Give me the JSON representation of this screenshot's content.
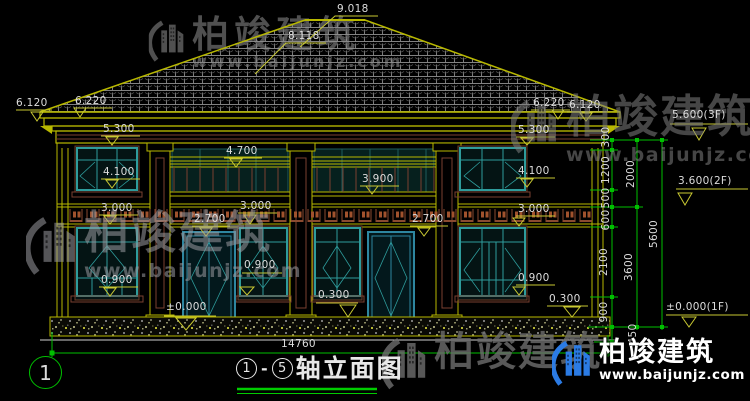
{
  "drawing": {
    "title": {
      "axis_from": "1",
      "dash": "-",
      "axis_to": "5",
      "text": "轴立面图"
    },
    "axis_marker": "1",
    "dim_labels": [
      {
        "t": "9.018",
        "x": 337,
        "y": 4
      },
      {
        "t": "8.118",
        "x": 288,
        "y": 31
      },
      {
        "t": "6.120",
        "x": 16,
        "y": 98
      },
      {
        "t": "6.220",
        "x": 75,
        "y": 96
      },
      {
        "t": "5.300",
        "x": 103,
        "y": 124
      },
      {
        "t": "4.100",
        "x": 103,
        "y": 167
      },
      {
        "t": "3.000",
        "x": 101,
        "y": 203
      },
      {
        "t": "0.900",
        "x": 101,
        "y": 275
      },
      {
        "t": "4.700",
        "x": 226,
        "y": 146
      },
      {
        "t": "3.900",
        "x": 362,
        "y": 174
      },
      {
        "t": "3.000",
        "x": 240,
        "y": 201
      },
      {
        "t": "2.700",
        "x": 194,
        "y": 214
      },
      {
        "t": "2.700",
        "x": 412,
        "y": 214
      },
      {
        "t": "0.900",
        "x": 244,
        "y": 260
      },
      {
        "t": "±0.000",
        "x": 166,
        "y": 302
      },
      {
        "t": "0.300",
        "x": 318,
        "y": 290
      },
      {
        "t": "6.220",
        "x": 533,
        "y": 98
      },
      {
        "t": "6.120",
        "x": 569,
        "y": 100
      },
      {
        "t": "5.300",
        "x": 518,
        "y": 125
      },
      {
        "t": "4.100",
        "x": 518,
        "y": 166
      },
      {
        "t": "3.000",
        "x": 518,
        "y": 204
      },
      {
        "t": "0.900",
        "x": 518,
        "y": 273
      },
      {
        "t": "0.300",
        "x": 549,
        "y": 294
      },
      {
        "t": "5.600(3F)",
        "x": 672,
        "y": 110
      },
      {
        "t": "3.600(2F)",
        "x": 678,
        "y": 176
      },
      {
        "t": "±0.000(1F)",
        "x": 666,
        "y": 302
      },
      {
        "t": "14760",
        "x": 281,
        "y": 339
      },
      {
        "t": "300",
        "x": 606,
        "y": 137,
        "rot": 1
      },
      {
        "t": "1200",
        "x": 606,
        "y": 170,
        "rot": 1
      },
      {
        "t": "500",
        "x": 606,
        "y": 198,
        "rot": 1
      },
      {
        "t": "600",
        "x": 606,
        "y": 220,
        "rot": 1
      },
      {
        "t": "2100",
        "x": 604,
        "y": 262,
        "rot": 1
      },
      {
        "t": "900",
        "x": 604,
        "y": 312,
        "rot": 1
      },
      {
        "t": "450",
        "x": 633,
        "y": 334,
        "rot": 1
      },
      {
        "t": "2000",
        "x": 631,
        "y": 174,
        "rot": 1
      },
      {
        "t": "3600",
        "x": 629,
        "y": 267,
        "rot": 1
      },
      {
        "t": "5600",
        "x": 654,
        "y": 234,
        "rot": 1
      }
    ]
  },
  "branding": {
    "name": "柏竣建筑",
    "url": "www.baijunjz.com"
  },
  "colors": {
    "line_yellow": "#B8B800",
    "dim_yellow": "#C8C832",
    "line_green": "#00C000",
    "window_teal": "#2E9C9C",
    "trim_brown": "#7A4030",
    "text": "#DCDCDC",
    "logo_blue": "#2B7BE4"
  }
}
